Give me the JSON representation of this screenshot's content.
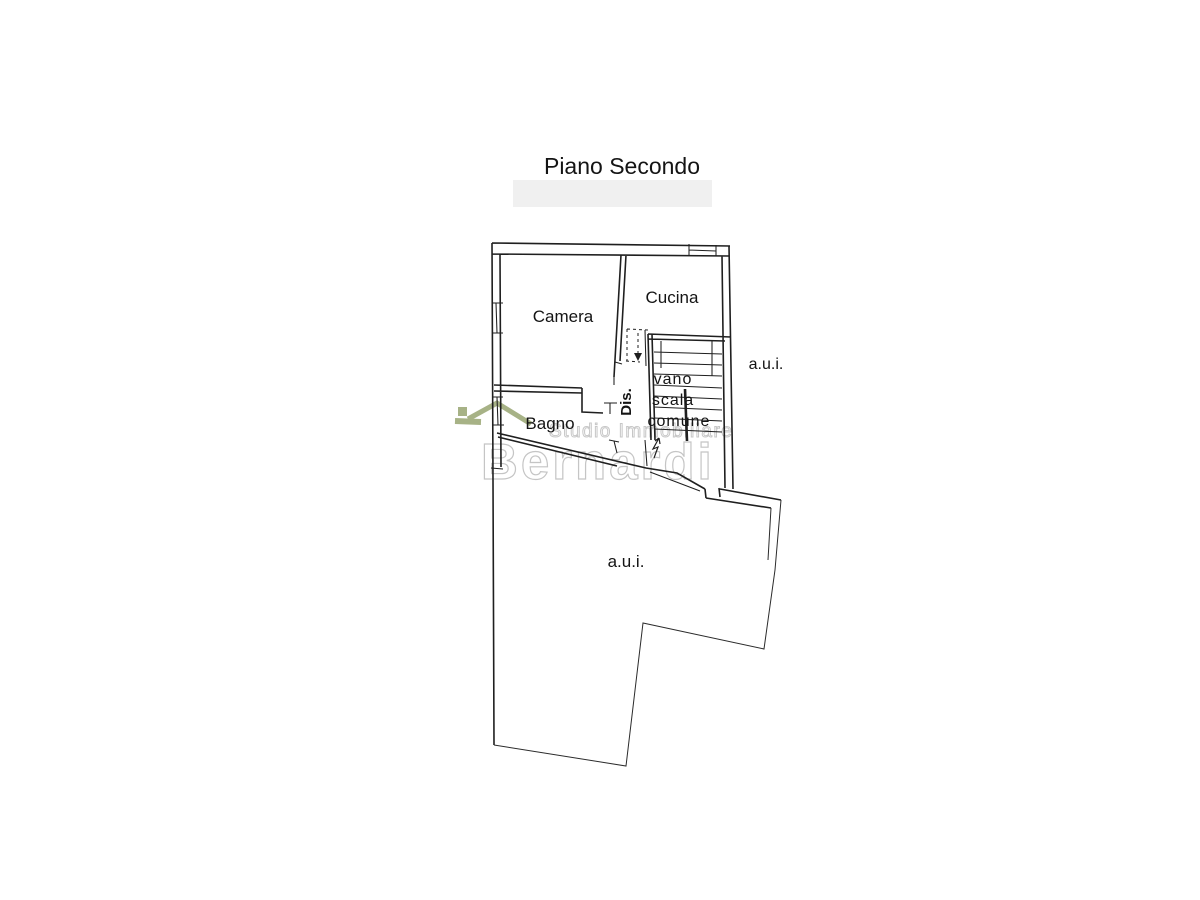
{
  "title": "Piano Secondo",
  "floor_plan": {
    "rooms": {
      "camera": "Camera",
      "cucina": "Cucina",
      "bagno": "Bagno",
      "dis": "Dis.",
      "stair_line1": "vano",
      "stair_line2": "scala",
      "stair_line3": "comune",
      "aui_right": "a.u.i.",
      "aui_lower": "a.u.i."
    }
  },
  "watermark": {
    "studio_line": "Studio Immobiliare",
    "brand": "Bernardi",
    "roof_color": "#a7b286",
    "text_color": "#c7c7c7"
  },
  "colors": {
    "line": "#1f1f1f",
    "thin_line": "#2b2b2b",
    "title_band": "#f0f0f0"
  }
}
